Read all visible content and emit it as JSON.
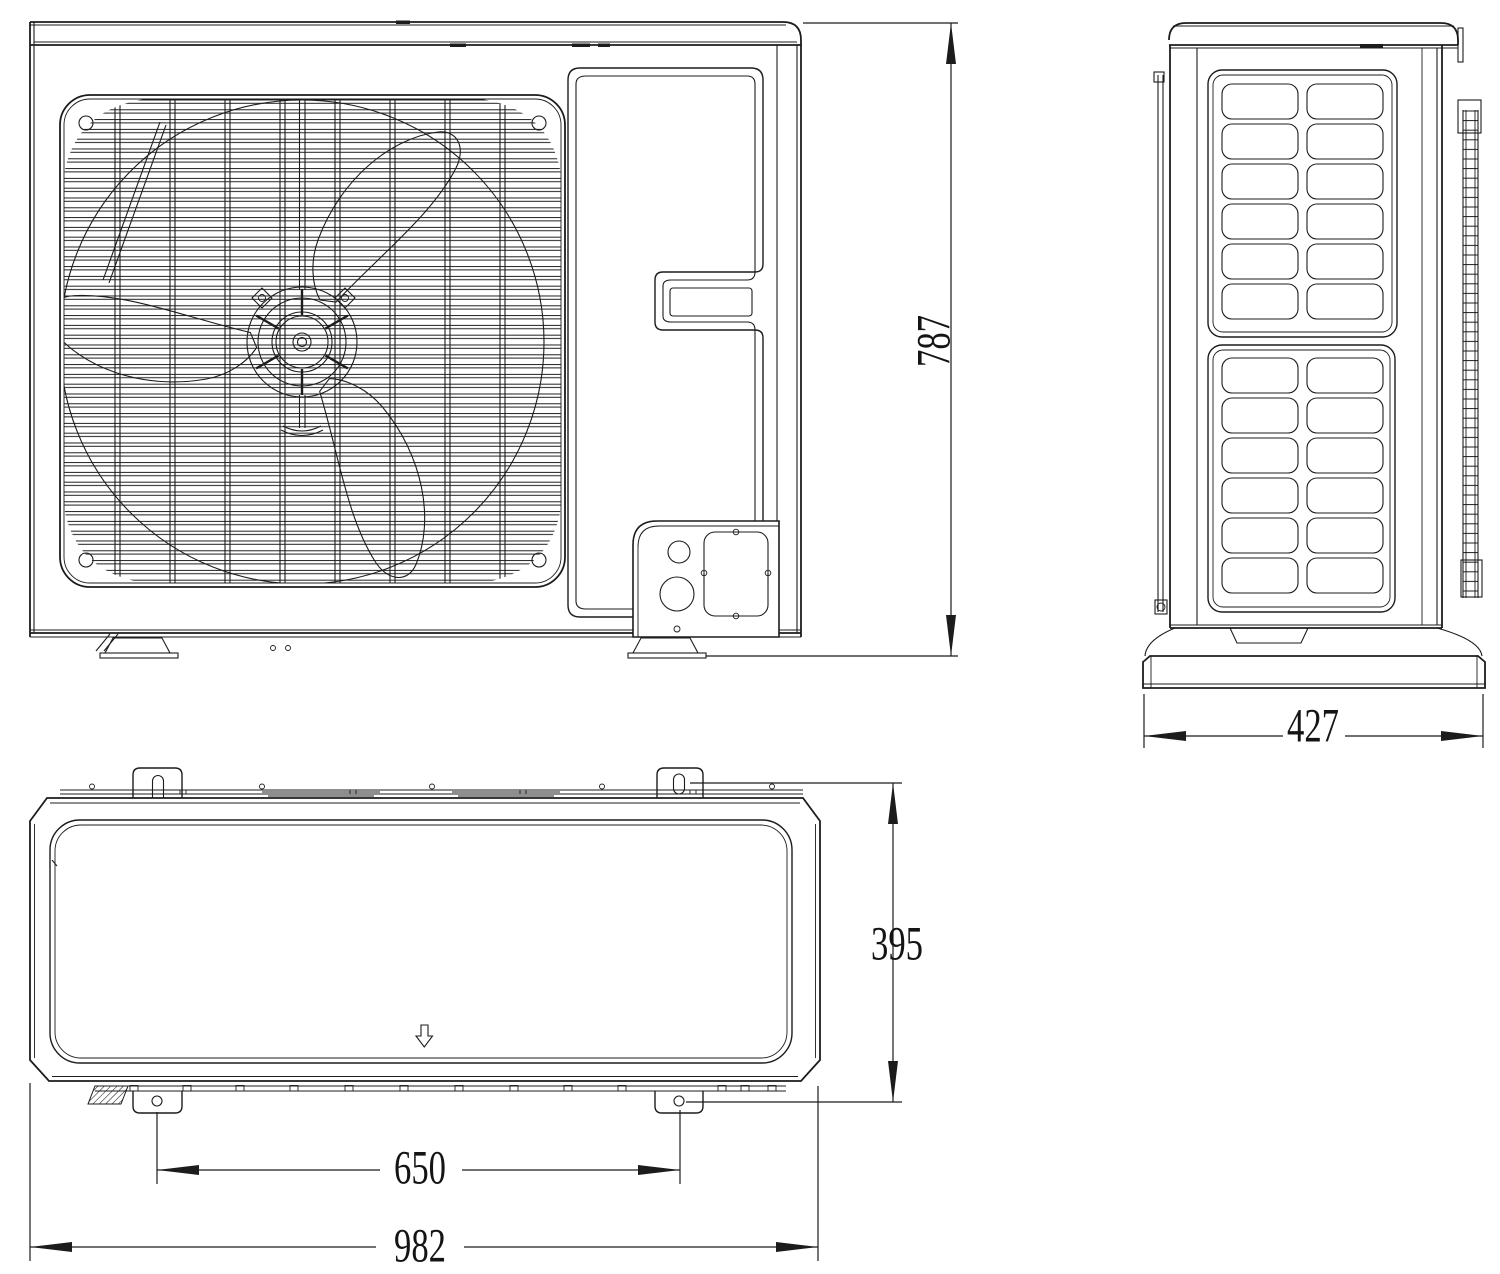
{
  "figure": {
    "background": "#ffffff",
    "line_color": "#1c1c1c",
    "text_color": "#141414"
  },
  "dimensions": {
    "height": "787",
    "depth": "427",
    "mounting_depth": "395",
    "foot_spacing": "650",
    "width": "982"
  },
  "icons": {
    "airflow_arrow": "hollow-down-arrow"
  }
}
